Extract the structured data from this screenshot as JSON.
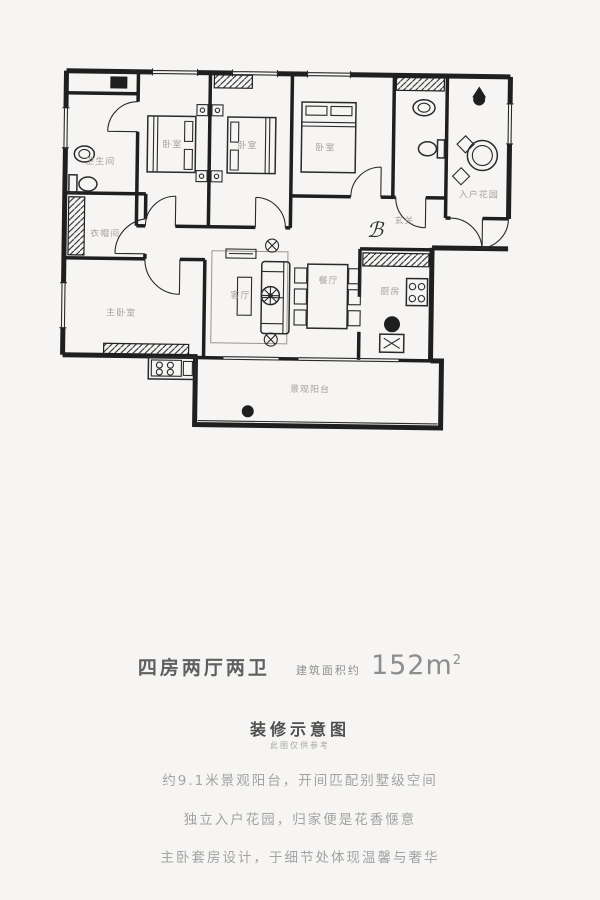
{
  "page": {
    "background": "#f6f5f3"
  },
  "floorplan": {
    "wall_color": "#1f1f1f",
    "room_label_color": "#a8a39e",
    "labels": {
      "bathroom_main": "卫生间",
      "cloakroom": "衣帽间",
      "master_bedroom": "主卧室",
      "bedroom_a": "卧室",
      "bedroom_b": "卧室",
      "bedroom_c": "卧室",
      "entry_garden": "入户花园",
      "foyer": "玄关",
      "living_room": "客厅",
      "dining_room": "餐厅",
      "kitchen": "厨房",
      "balcony": "景观阳台"
    },
    "foyer_flourish": "ℬ"
  },
  "summary": {
    "layout": "四房两厅两卫",
    "area_label": "建筑面积约",
    "area_value": "152m",
    "area_sup": "2"
  },
  "caption": {
    "title": "装修示意图",
    "note": "此图仅供参考"
  },
  "features": [
    "约9.1米景观阳台，开间匹配别墅级空间",
    "独立入户花园，归家便是花香惬意",
    "主卧套房设计，于细节处体现温馨与奢华"
  ]
}
